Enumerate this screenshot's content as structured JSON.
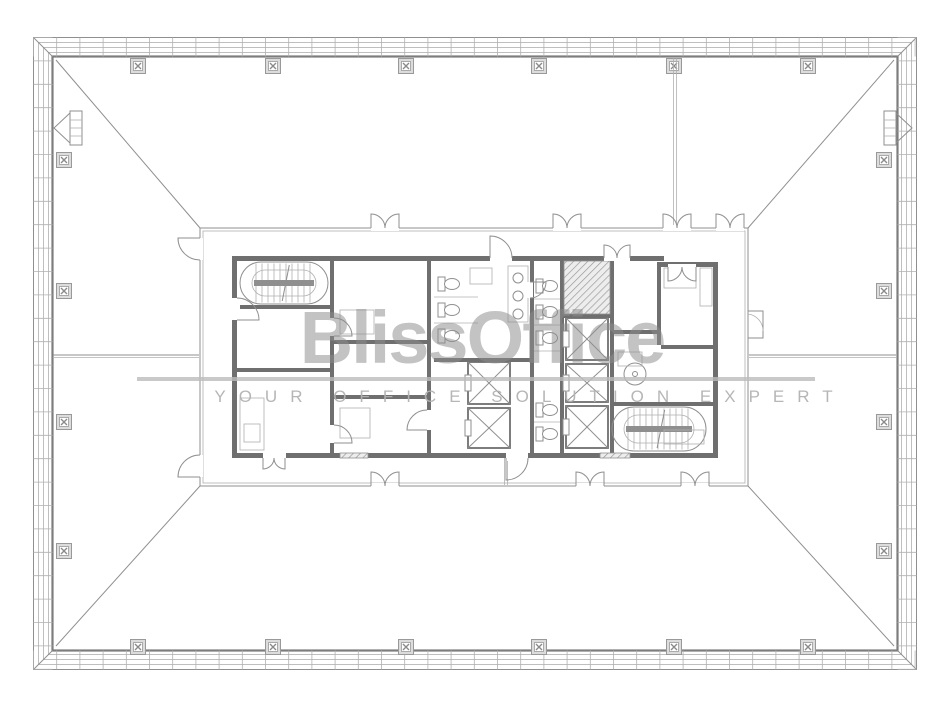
{
  "watermark": {
    "brand": "BlissOffice",
    "tagline": "YOUR OFFICE SOLUTION EXPERT"
  },
  "plan": {
    "colors": {
      "line": "#8f8f8f",
      "line_dark": "#7d7d7d",
      "line_light": "#b0b0b0",
      "wall": "#6f6f6f",
      "hatch_bg": "#ededed",
      "watermark_text": "#8d8d8d",
      "watermark_tagline": "#b3b3b3",
      "watermark_bar": "#bcbcbc",
      "background": "#ffffff"
    },
    "icons": {
      "column": "crossed-square-column-symbol",
      "elevator": "x-crossed-shaft-box",
      "stair": "racetrack-stair-with-treads",
      "toilet": "tank-and-bowl-fixture",
      "door": "quarter-arc-swing"
    }
  }
}
